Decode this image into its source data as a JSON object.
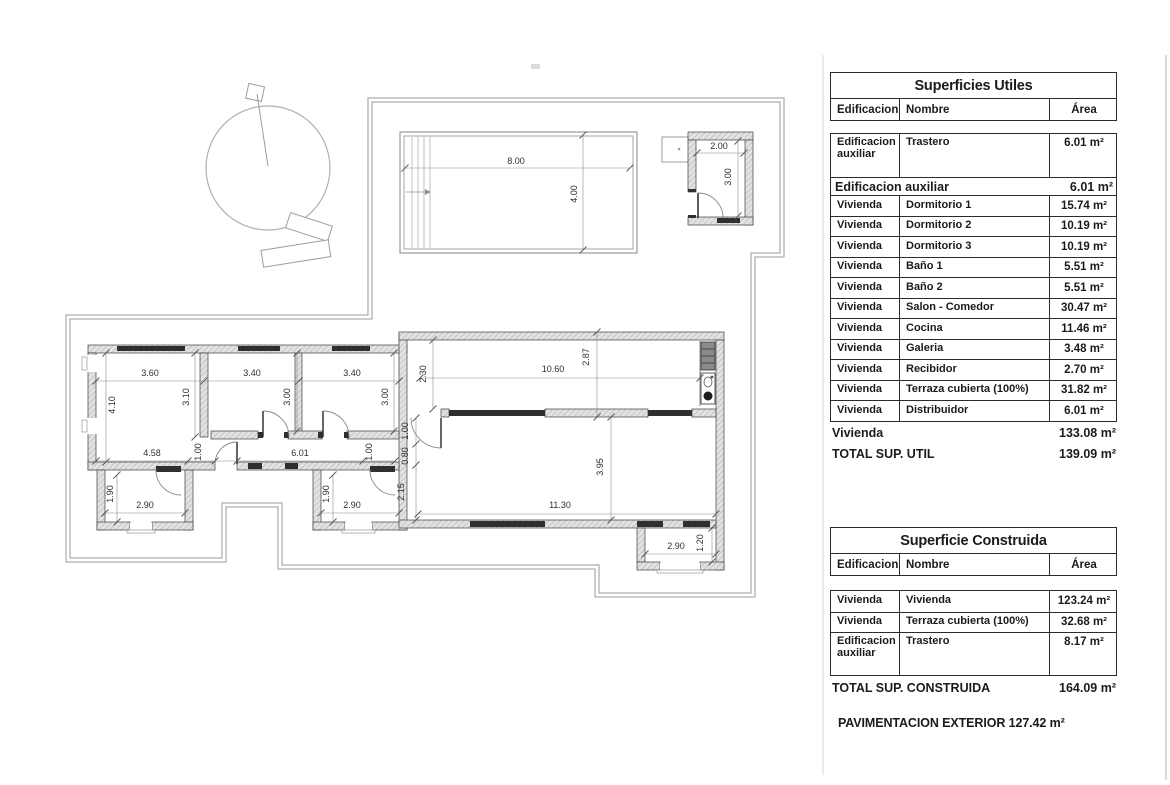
{
  "tables": {
    "utiles": {
      "title": "Superficies Utiles",
      "headers": [
        "Edificacion",
        "Nombre",
        "Área"
      ],
      "rows": [
        {
          "tall": true,
          "ed": "Edificacion auxiliar",
          "nombre": "Trastero",
          "area": "6.01 m²"
        },
        {
          "subtotal": true,
          "label": "Edificacion auxiliar",
          "area": "6.01 m²"
        },
        {
          "ed": "Vivienda",
          "nombre": "Dormitorio 1",
          "area": "15.74 m²"
        },
        {
          "ed": "Vivienda",
          "nombre": "Dormitorio 2",
          "area": "10.19 m²"
        },
        {
          "ed": "Vivienda",
          "nombre": "Dormitorio 3",
          "area": "10.19 m²"
        },
        {
          "ed": "Vivienda",
          "nombre": "Baño 1",
          "area": "5.51 m²"
        },
        {
          "ed": "Vivienda",
          "nombre": "Baño 2",
          "area": "5.51 m²"
        },
        {
          "ed": "Vivienda",
          "nombre": "Salon - Comedor",
          "area": "30.47 m²"
        },
        {
          "ed": "Vivienda",
          "nombre": "Cocina",
          "area": "11.46 m²"
        },
        {
          "ed": "Vivienda",
          "nombre": "Galeria",
          "area": "3.48 m²"
        },
        {
          "ed": "Vivienda",
          "nombre": "Recibidor",
          "area": "2.70 m²"
        },
        {
          "ed": "Vivienda",
          "nombre": "Terraza cubierta (100%)",
          "area": "31.82 m²"
        },
        {
          "ed": "Vivienda",
          "nombre": "Distribuidor",
          "area": "6.01 m²"
        }
      ],
      "totals": [
        {
          "label": "Vivienda",
          "area": "133.08 m²"
        },
        {
          "label": "TOTAL SUP. UTIL",
          "area": "139.09 m²"
        }
      ]
    },
    "construida": {
      "title": "Superficie Construida",
      "headers": [
        "Edificacion",
        "Nombre",
        "Área"
      ],
      "rows": [
        {
          "ed": "Vivienda",
          "nombre": "Vivienda",
          "area": "123.24 m²"
        },
        {
          "ed": "Vivienda",
          "nombre": "Terraza cubierta (100%)",
          "area": "32.68 m²"
        },
        {
          "tall": true,
          "ed": "Edificacion auxiliar",
          "nombre": "Trastero",
          "area": "8.17 m²"
        }
      ],
      "totals": [
        {
          "label": "TOTAL SUP. CONSTRUIDA",
          "area": "164.09 m²"
        }
      ]
    },
    "pavimentacion": "PAVIMENTACION EXTERIOR 127.42 m²"
  },
  "plan": {
    "dimensions": [
      {
        "t": "8.00",
        "x": 516,
        "y": 164,
        "r": 0
      },
      {
        "t": "4.00",
        "x": 577,
        "y": 194,
        "r": 90
      },
      {
        "t": "2.00",
        "x": 719,
        "y": 149,
        "r": 0
      },
      {
        "t": "3.00",
        "x": 731,
        "y": 177,
        "r": 90
      },
      {
        "t": "3.60",
        "x": 150,
        "y": 376,
        "r": 0
      },
      {
        "t": "3.40",
        "x": 252,
        "y": 376,
        "r": 0
      },
      {
        "t": "3.40",
        "x": 352,
        "y": 376,
        "r": 0
      },
      {
        "t": "4.10",
        "x": 115,
        "y": 405,
        "r": 90
      },
      {
        "t": "3.10",
        "x": 189,
        "y": 397,
        "r": 90
      },
      {
        "t": "3.00",
        "x": 290,
        "y": 397,
        "r": 90
      },
      {
        "t": "3.00",
        "x": 388,
        "y": 397,
        "r": 90
      },
      {
        "t": "4.58",
        "x": 152,
        "y": 456,
        "r": 0
      },
      {
        "t": "1.00",
        "x": 201,
        "y": 452,
        "r": 90
      },
      {
        "t": "6.01",
        "x": 300,
        "y": 456,
        "r": 0
      },
      {
        "t": "1.00",
        "x": 372,
        "y": 452,
        "r": 90
      },
      {
        "t": "1.00",
        "x": 408,
        "y": 431,
        "r": 90
      },
      {
        "t": "0.80",
        "x": 408,
        "y": 456,
        "r": 90
      },
      {
        "t": "2.15",
        "x": 404,
        "y": 492,
        "r": 90
      },
      {
        "t": "2.30",
        "x": 426,
        "y": 374,
        "r": 90
      },
      {
        "t": "10.60",
        "x": 553,
        "y": 372,
        "r": 0
      },
      {
        "t": "2.87",
        "x": 589,
        "y": 357,
        "r": 90
      },
      {
        "t": "11.30",
        "x": 560,
        "y": 508,
        "r": 0
      },
      {
        "t": "3.95",
        "x": 603,
        "y": 467,
        "r": 90
      },
      {
        "t": "2.90",
        "x": 145,
        "y": 508,
        "r": 0
      },
      {
        "t": "1.90",
        "x": 113,
        "y": 494,
        "r": 90
      },
      {
        "t": "2.90",
        "x": 352,
        "y": 508,
        "r": 0
      },
      {
        "t": "1.90",
        "x": 329,
        "y": 494,
        "r": 90
      },
      {
        "t": "2.90",
        "x": 676,
        "y": 549,
        "r": 0
      },
      {
        "t": "1.20",
        "x": 703,
        "y": 543,
        "r": 90
      }
    ],
    "colors": {
      "wall_fill": "#e2e2e2",
      "wall_edge": "#3f3f3f",
      "window_dark": "#2f2f2f",
      "boundary": "#9a9a9a",
      "dim_line": "#8a8a8a",
      "dim_text": "#2e2e2e"
    }
  }
}
